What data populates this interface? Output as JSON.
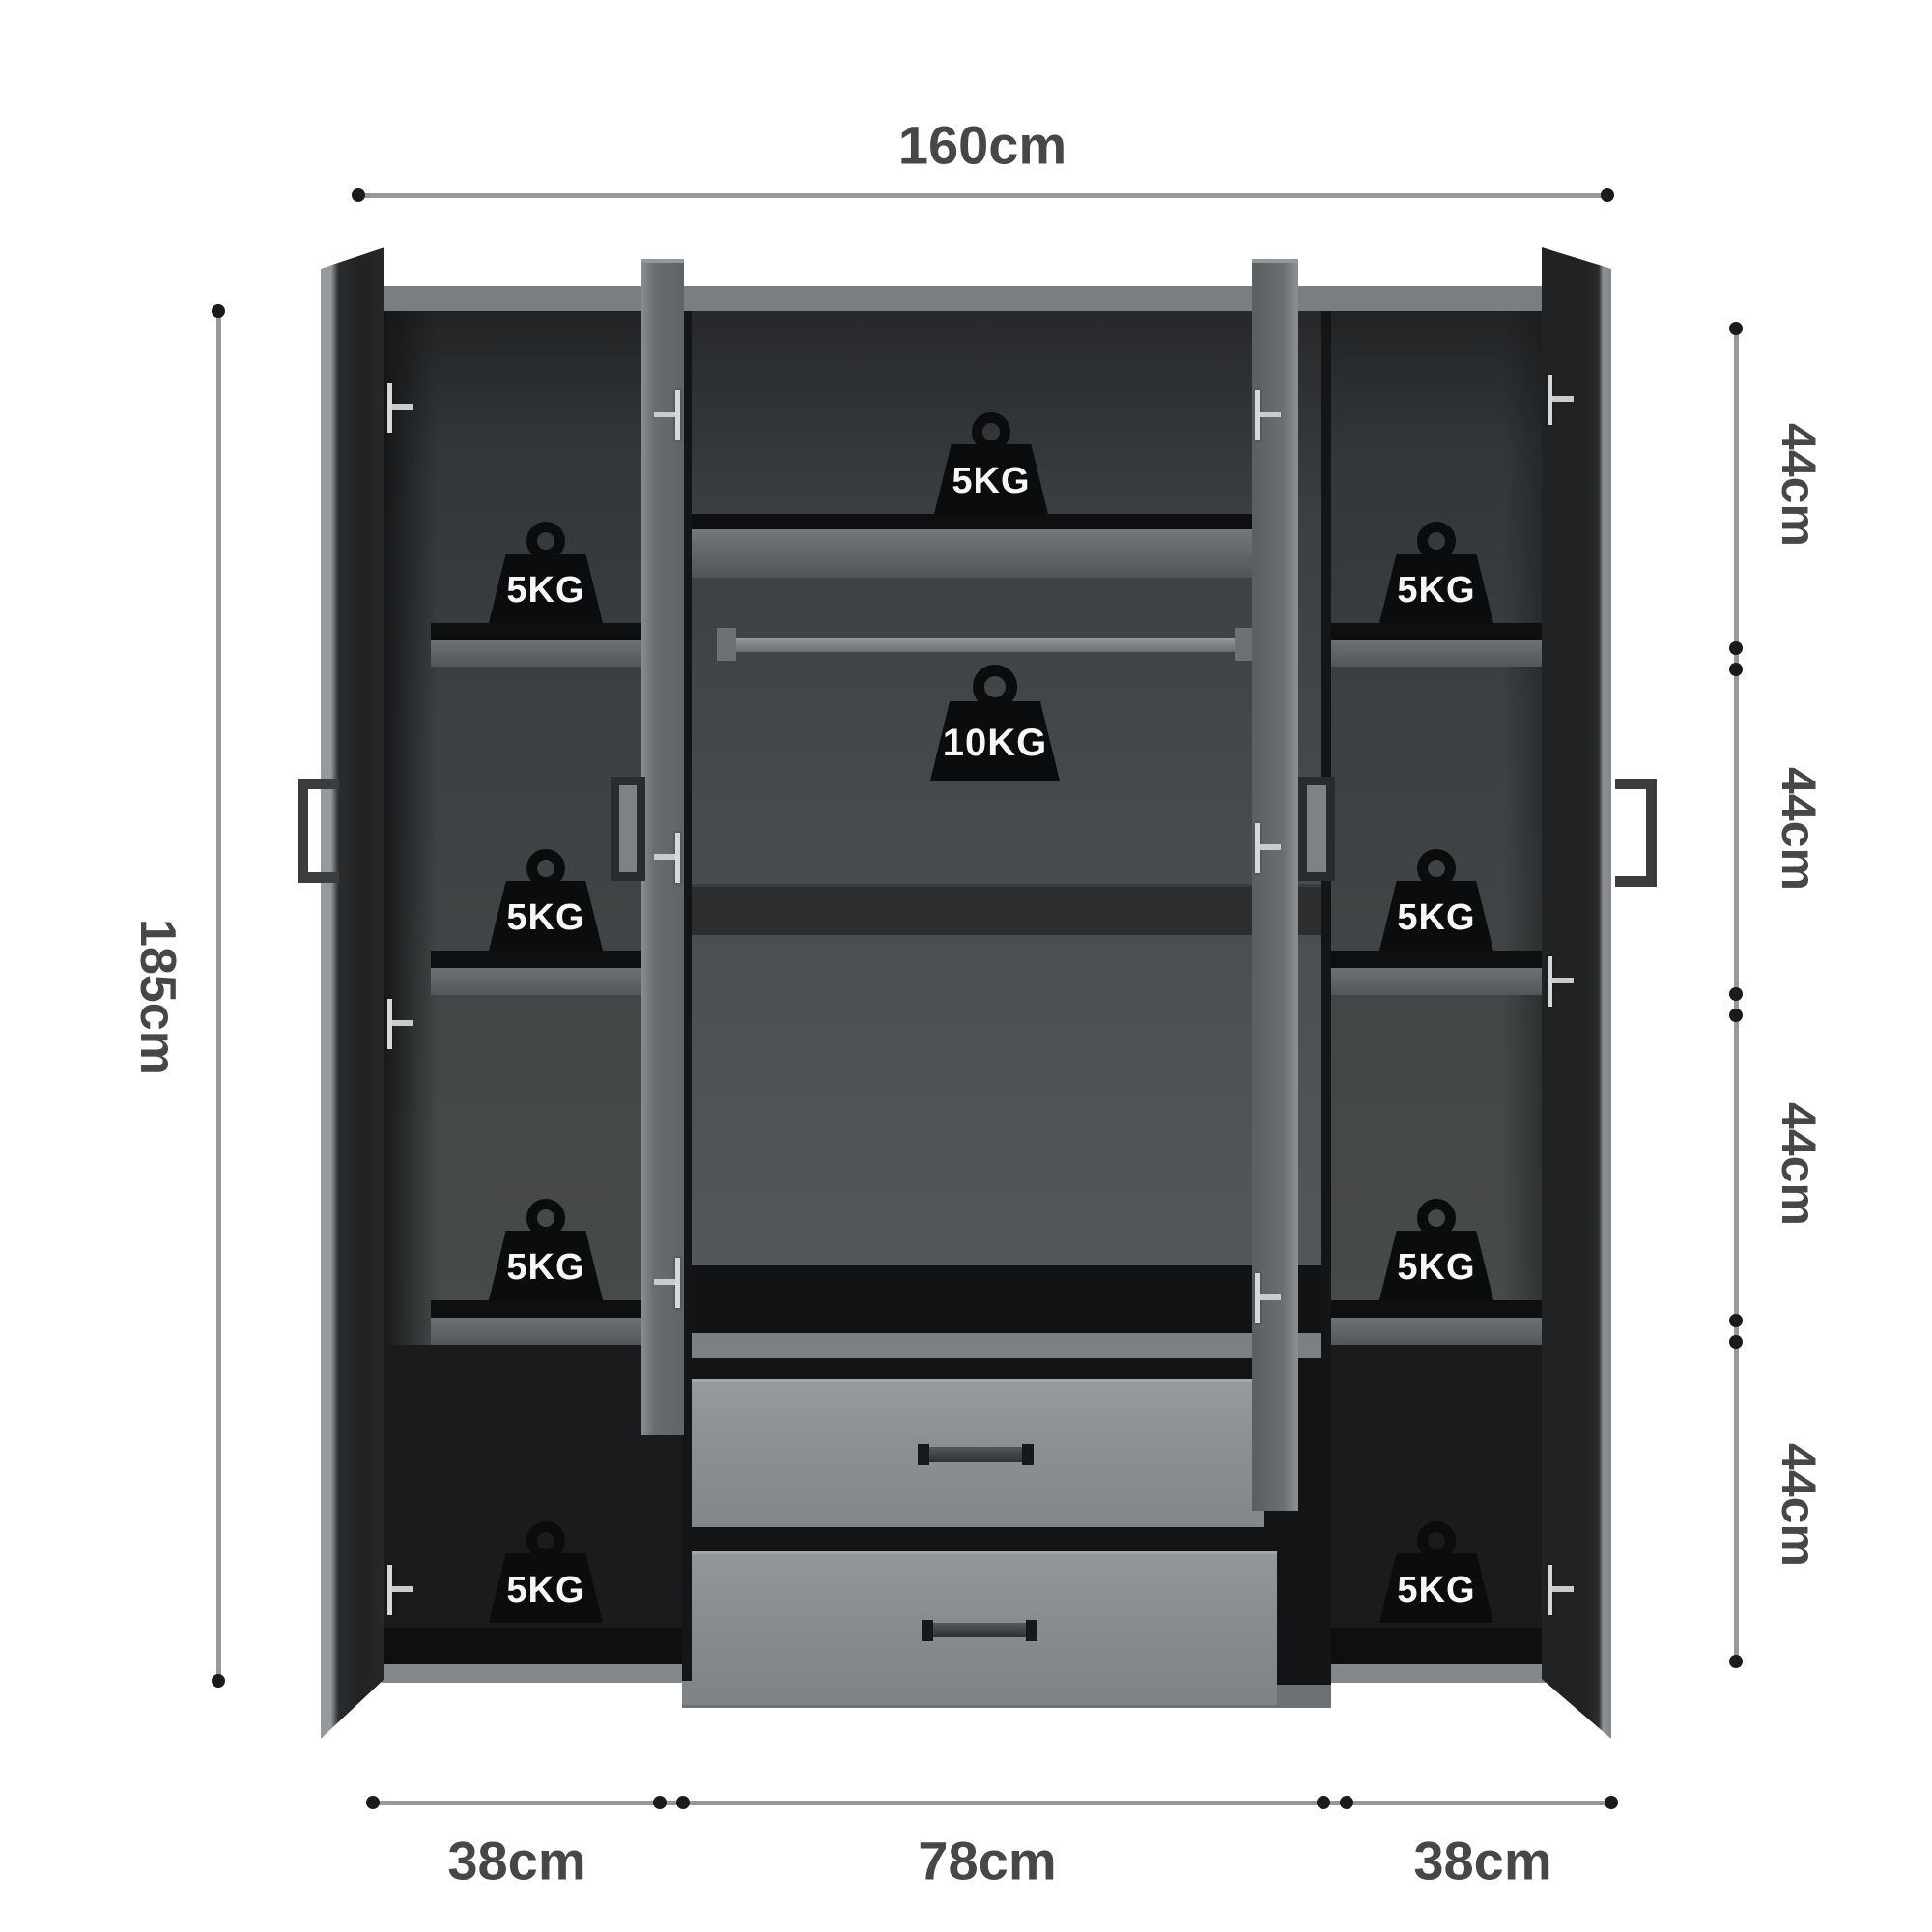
{
  "dimensions": {
    "width_top": "160cm",
    "height_left": "185cm",
    "right_sections": [
      "44cm",
      "44cm",
      "44cm",
      "44cm"
    ],
    "bottom_sections": [
      "38cm",
      "78cm",
      "38cm"
    ]
  },
  "load_badges": {
    "left_shelves": [
      "5KG",
      "5KG",
      "5KG",
      "5KG"
    ],
    "center_top_shelf": "5KG",
    "hanging_rail": "10KG",
    "right_shelves": [
      "5KG",
      "5KG",
      "5KG",
      "5KG"
    ]
  },
  "colors": {
    "background": "#ffffff",
    "door_face_gray": "#6a6d70",
    "interior_back_gray": "#4b4e51",
    "interior_shadow_black": "#141517",
    "drawer_front_gray": "#8d9093",
    "badge_black": "#0b0c0d",
    "badge_text": "#ffffff",
    "dimension_line": "#96989a",
    "dimension_text": "#474747"
  }
}
